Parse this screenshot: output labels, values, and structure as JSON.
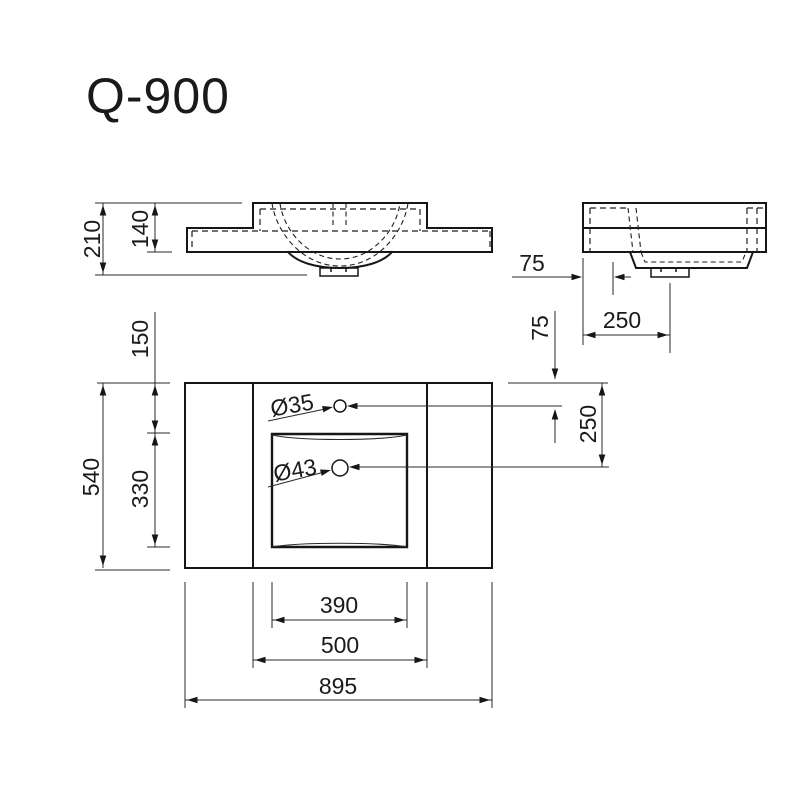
{
  "title": "Q-900",
  "colors": {
    "background": "#ffffff",
    "line_primary": "#161616",
    "line_thin": "#2a2a2a"
  },
  "dimensions": {
    "front_view": {
      "total_height": "210",
      "deck_height": "140"
    },
    "side_view": {
      "faucet_offset": "75",
      "drain_offset": "250"
    },
    "plan_view": {
      "right": {
        "faucet_offset": "75",
        "drain_offset": "250"
      },
      "left": {
        "rim_to_basin": "150",
        "basin_length": "330",
        "total_depth": "540"
      },
      "bottom": {
        "basin_width": "390",
        "deck_width": "500",
        "total_width": "895"
      },
      "holes": {
        "faucet": "Ø35",
        "drain": "Ø43"
      }
    }
  }
}
